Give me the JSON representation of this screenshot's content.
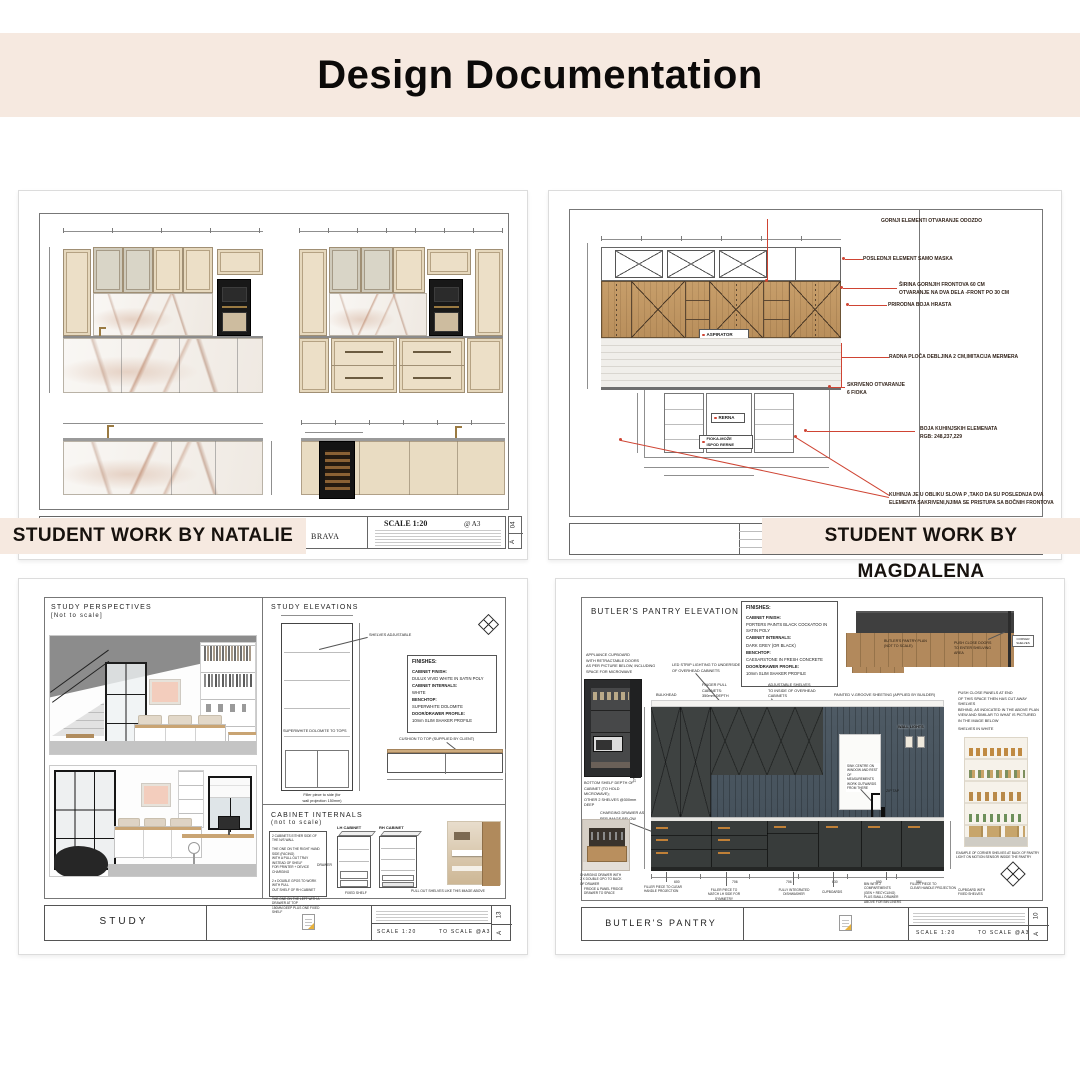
{
  "header": {
    "title": "Design Documentation"
  },
  "badges": {
    "natalie": "STUDENT WORK BY NATALIE",
    "magdalena": "STUDENT WORK BY MAGDALENA"
  },
  "natalie": {
    "title_block": {
      "scale": "SCALE 1:20",
      "paper": "@ A3",
      "project": "BRAVA",
      "sheet_no": "04",
      "sheet_letter": "A"
    }
  },
  "magdalena": {
    "drawing_labels": {
      "aspirator": "ASPIRATOR",
      "oven": "RERNA",
      "drawer": "FIOKA-MOŽE\nISPOD RERNE"
    },
    "annotations": [
      "GORNJI ELEMENTI OTVARANJE ODOZDO",
      "POSLEDNJI ELEMENT SAMO MASKA",
      "ŠIRINA GORNJIH FRONTOVA 60 CM\nOTVARANJE NA DVA DELA -FRONT PO 30 CM",
      "PRIRODNA BOJA HRASTA",
      "RADNA PLOČA DEBLJINA 2 CM,IMITACIJA MERMERA",
      "SKRIVENO OTVARANJE\n6 FIOKA",
      "BOJA KUHINJSKIH ELEMENATA\nRGB: 248,237,229",
      "KUHINJA JE U OBLIKU SLOVA P ,TAKO DA SU POSLEDNJA DVA\nELEMENTA SAKRIVENI,NJIMA SE PRISTUPA SA BOČNIH FRONTOVA"
    ]
  },
  "study": {
    "perspectives_title": "STUDY PERSPECTIVES",
    "perspectives_sub": "[Not to scale]",
    "elevations_title": "STUDY ELEVATIONS",
    "internals_title": "CABINET INTERNALS",
    "internals_sub": "(not to scale)",
    "finishes": {
      "title": "FINISHES:",
      "lines": [
        "CABINET FINISH:",
        "DULUX VIVID WHITE IN SATIN POLY",
        "CABINET INTERNALS:",
        "WHITE",
        "BENCHTOP:",
        "SUPERWHITE DOLOMITE",
        "DOOR/DRAWER PROFILE:",
        "10mm SLIM SHAKER PROFILE"
      ]
    },
    "labels": {
      "shelves": "SHELVES ADJUSTABLE",
      "benchtop": "SUPERWHITE DOLOMITE TO TOPS",
      "cushion": "CUSHION TO TOP (SUPPLIED BY CLIENT)",
      "filler": "Filler piece to side (for\nwall projection 150mm)",
      "lh": "LH CABINET",
      "rh": "RH CABINET",
      "drawer": "DRAWER",
      "fixed_shelf": "FIXED SHELF",
      "pullout": "PULL OUT SHELVES LIKE THIS IMAGE ABOVE"
    },
    "notes": "2 CABINETS EITHER SIDE OF\nTHE N/S WALL\n\nTHE ONE ON THE RIGHT HAND\nSIDE (FACING)\nWITH A PULL OUT TRAY\nINSTEAD OF SHELF\nFOR PRINTER + DEVICE\nCHARGING\n\n2 x DOUBLE GPOS TO WORK\nWITH PULL\nOUT SHELF OF RH CABINET\n\nTHE ONE ON THE LEFT WITH A\nDRAWER AT TOP\n150MM DEEP PLUS ONE FIXED\nSHELF",
    "title_block": {
      "name": "STUDY",
      "scale": "SCALE 1:20",
      "to_scale": "TO SCALE @A3",
      "sheet_no": "13",
      "sheet_letter": "A"
    }
  },
  "pantry": {
    "heading": "BUTLER'S PANTRY ELEVATION",
    "finishes": {
      "title": "FINISHES:",
      "lines": [
        "CABINET FINISH:",
        "PORTERS PAINTS BLACK COCKATOO IN SATIN POLY",
        "CABINET INTERNALS:",
        "DARK GREY (OR BLACK)",
        "BENCHTOP:",
        "CAESARSTONE IN FRESH CONCRETE",
        "DOOR/DRAWER PROFILE:",
        "10mm SLIM SHAKER PROFILE"
      ]
    },
    "plan": {
      "label": "BUTLER'S PANTRY PLAN\n(NOT TO SCALE)",
      "push": "PUSH CLOSE DOORS\nTO ENTER SHELVING\nAREA",
      "corner": "CORNER\nSHELVES"
    },
    "right_note": "PUSH CLOSE PANELS AT END\nOF THIS SPACE THEN HAS CUT AWAY SHELVES\nBEHIND, AS INDICATED IN THE ABOVE PLAN\nVIEW AND SIMILAR TO WHAT IS PICTURED\nIN THE IMAGE BELOW",
    "shelves_white": "SHELVES IN WHITE",
    "photo_caption": "EXAMPLE OF CORNER SHELVES AT BACK OF PANTRY\nLIGHT ON MOTION SENSOR INSIDE THE PANTRY",
    "appliance_note": "APPLIANCE CUPBOARD\nWITH RETRACTABLE DOORS\nAS PER PICTURE BELOW, INCLUDING\nSPACE FOR MICROWAVE",
    "bottom_shelf_note": "BOTTOM SHELF DEPTH OF\nCABINET (TO HOLD\nMICROWAVE);\nOTHER 2 SHELVES @300mm\nDEEP",
    "charging_note": "CHARGING DRAWER AS\nPER IMAGE BELOW",
    "charging_caption": "CHARGING DRAWER WITH\n2 X DOUBLE GPO TO BACK\nOF DRAWER",
    "fridge_note": "FRIDGE & PANEL FRIDGE\nDRAWER TO SPACE",
    "labels": {
      "bulkhead": "BULKHEAD",
      "finger_pull": "FINGER PULL\nCABINETS:\n350mm DEPTH",
      "led": "LED STRIP LIGHTING TO UNDERSIDE\nOF OVERHEAD CABINETS",
      "adjustable": "ADJUSTABLE SHELVES\nTO INSIDE OF OVERHEAD\nCABINETS",
      "vgroove": "PAINTED V-GROOVE SHEETING (APPLIED BY BUILDER)",
      "wall_lights": "WALL LIGHTS",
      "sink": "SINK CENTRE ON\nWINDOW AND REST\nOF MEASUREMENTS\nWORK OUTWARDS\nFROM THERE",
      "zip": "ZIP TAP",
      "filler1": "FILLER PIECE TO CLEAR\nHANDLE PROJECTION",
      "filler2": "FILLER PIECE TO\nMATCH LH SIDE FOR\nSYMMETRY",
      "dishwasher": "FULLY INTEGRATED\nDISHWASHER",
      "cupboards": "CUPBOARDS",
      "bin": "BIN WITH 2\nCOMPARTMENTS\n(GEN + RECYCLING)\nPLUS SMALL DRAWER\nABOVE FOR BIN LINERS",
      "filler3": "FILLER PIECE TO\nCLEAR HANDLE PROJECTION",
      "fixed": "CUPBOARD WITH\nFIXED SHELVES"
    },
    "dims": {
      "bottom": [
        "600",
        "706",
        "706",
        "630",
        "900",
        "584"
      ],
      "height": "2700"
    },
    "title_block": {
      "name": "BUTLER'S PANTRY",
      "scale": "SCALE 1:20",
      "to_scale": "TO SCALE @A3",
      "sheet_no": "10",
      "sheet_letter": "A"
    }
  }
}
